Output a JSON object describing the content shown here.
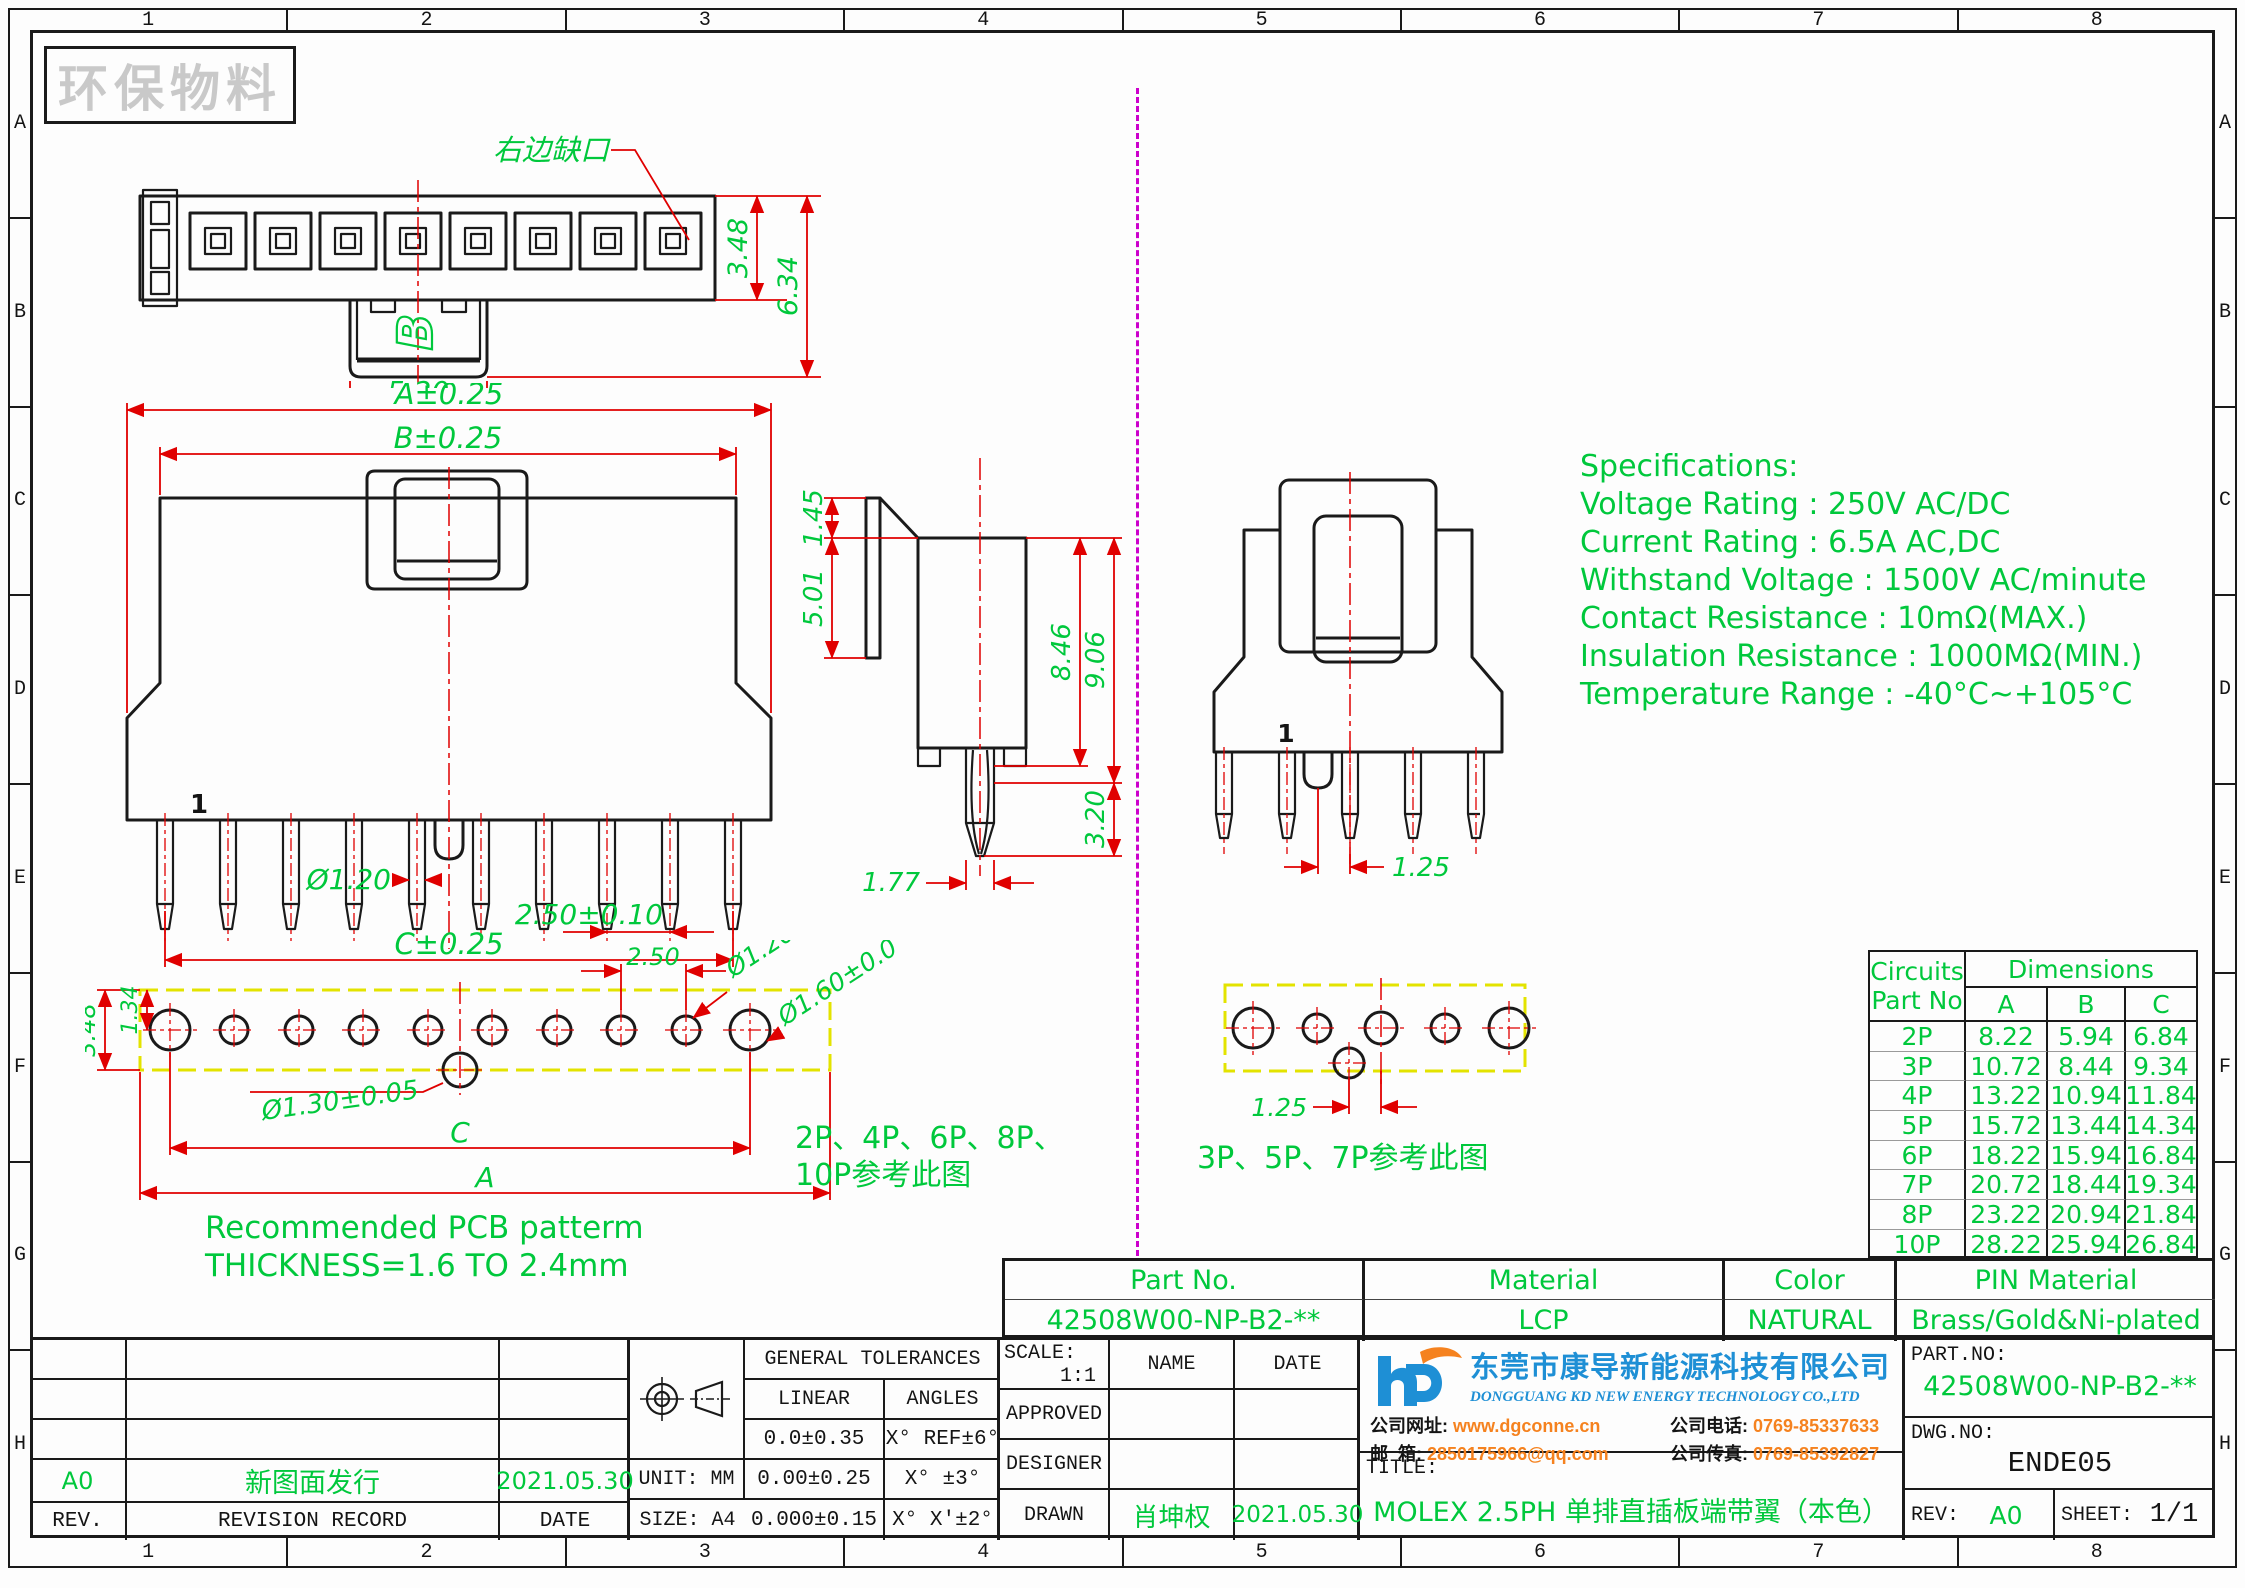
{
  "colors": {
    "cad_green": "#00c83c",
    "cad_red": "#e00000",
    "divider_magenta": "#cc00cc",
    "pcb_yellow": "#e3e300",
    "accent_orange": "#f5821f",
    "logo_blue": "#1e8fd5"
  },
  "border": {
    "columns": [
      "1",
      "2",
      "3",
      "4",
      "5",
      "6",
      "7",
      "8"
    ],
    "rows": [
      "A",
      "B",
      "C",
      "D",
      "E",
      "F",
      "G",
      "H"
    ]
  },
  "watermark": "环保物料",
  "top_view": {
    "notch_label": "右边缺口",
    "marker": "B",
    "dim_width": "5.20",
    "dim_height_upper": "3.48",
    "dim_height_total": "6.34"
  },
  "front_view": {
    "dim_a": "A±0.25",
    "dim_b": "B±0.25",
    "dim_c": "C±0.25",
    "pin_dia": "Ø1.20",
    "pitch": "2.50±0.10",
    "pin_one": "1"
  },
  "side_view": {
    "dim_top": "1.45",
    "dim_face": "5.01",
    "dim_body": "8.46",
    "dim_total": "9.06",
    "dim_pin": "3.20",
    "dim_tip": "1.77"
  },
  "front_view_odd": {
    "half_pitch": "1.25",
    "pin_one": "1"
  },
  "pcb_even": {
    "dim_height": "3.48",
    "dim_offset": "1.34",
    "pitch": "2.50",
    "hole_small": "Ø1.20±0.05",
    "hole_large": "Ø1.60±0.05",
    "hole_mid": "Ø1.30±0.05",
    "dim_c": "C",
    "dim_a": "A",
    "note1": "Recommended PCB patterm",
    "note2": "THICKNESS=1.6 TO 2.4mm",
    "ref1": "2P、4P、6P、8P、",
    "ref2": "10P参考此图"
  },
  "pcb_odd": {
    "half_pitch": "1.25",
    "ref": "3P、5P、7P参考此图"
  },
  "specs": {
    "title": "Specifications:",
    "lines": [
      "Voltage Rating : 250V AC/DC",
      "Current Rating : 6.5A AC,DC",
      "Withstand Voltage : 1500V AC/minute",
      "Contact Resistance : 10mΩ(MAX.)",
      "Insulation Resistance : 1000MΩ(MIN.)",
      "Temperature Range : -40°C~+105°C"
    ]
  },
  "circuits_table": {
    "h_circuits": "Circuits",
    "h_partno": "Part No",
    "h_dimensions": "Dimensions",
    "h_a": "A",
    "h_b": "B",
    "h_c": "C",
    "rows": [
      [
        "2P",
        "8.22",
        "5.94",
        "6.84"
      ],
      [
        "3P",
        "10.72",
        "8.44",
        "9.34"
      ],
      [
        "4P",
        "13.22",
        "10.94",
        "11.84"
      ],
      [
        "5P",
        "15.72",
        "13.44",
        "14.34"
      ],
      [
        "6P",
        "18.22",
        "15.94",
        "16.84"
      ],
      [
        "7P",
        "20.72",
        "18.44",
        "19.34"
      ],
      [
        "8P",
        "23.22",
        "20.94",
        "21.84"
      ],
      [
        "10P",
        "28.22",
        "25.94",
        "26.84"
      ]
    ]
  },
  "part_band": {
    "h_part": "Part No.",
    "h_material": "Material",
    "h_color": "Color",
    "h_pin": "PIN Material",
    "v_part": "42508W00-NP-B2-**",
    "v_material": "LCP",
    "v_color": "NATURAL",
    "v_pin": "Brass/Gold&Ni-plated"
  },
  "revision": {
    "rev_value": "A0",
    "record_value": "新图面发行",
    "date_value": "2021.05.30",
    "h_rev": "REV.",
    "h_record": "REVISION RECORD",
    "h_date": "DATE"
  },
  "tolerances": {
    "title": "GENERAL TOLERANCES",
    "linear": "LINEAR",
    "angles": "ANGLES",
    "rows": [
      [
        "0.0±0.35",
        "X° REF±6°"
      ],
      [
        "0.00±0.25",
        "X° ±3°"
      ],
      [
        "0.000±0.15",
        "X° X'±2°"
      ]
    ],
    "unit": "UNIT: MM",
    "size": "SIZE: A4"
  },
  "approval": {
    "scale_label": "SCALE:",
    "scale_value": "1:1",
    "name": "NAME",
    "date": "DATE",
    "approved": "APPROVED",
    "designer": "DESIGNER",
    "drawn": "DRAWN",
    "drawn_name": "肖坤权",
    "drawn_date": "2021.05.30"
  },
  "company": {
    "name_cn": "东莞市康导新能源科技有限公司",
    "name_en": "DONGGUANG KD NEW ENERGY TECHNOLOGY CO.,LTD",
    "website_label": "公司网址:",
    "website": "www.dgconne.cn",
    "phone_label": "公司电话:",
    "phone": "0769-85337633",
    "email_label": "邮  箱:",
    "email": "2850175966@qq.com",
    "fax_label": "公司传真:",
    "fax": "0769-85392827"
  },
  "title_block": {
    "title_label": "TITLE:",
    "title_value": "MOLEX 2.5PH 单排直插板端带翼（本色）",
    "part_label": "PART.NO:",
    "part_value": "42508W00-NP-B2-**",
    "dwg_label": "DWG.NO:",
    "dwg_value": "ENDE05",
    "rev_label": "REV:",
    "rev_value": "A0",
    "sheet_label": "SHEET:",
    "sheet_value": "1/1"
  }
}
